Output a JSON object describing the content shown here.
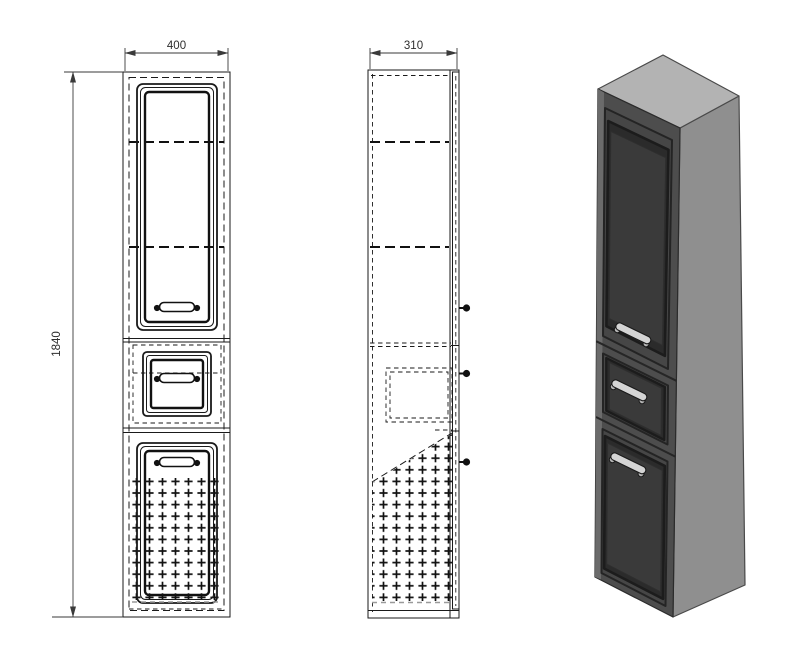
{
  "drawing": {
    "type": "furniture-technical-drawing",
    "views": {
      "front": "front-orthographic-view",
      "side": "side-orthographic-view",
      "perspective": "3d-perspective-view"
    },
    "dimensions": {
      "width": "400",
      "depth": "310",
      "height": "1840"
    },
    "colors": {
      "background": "#ffffff",
      "line": "#1a1a1a",
      "dim_line": "#3a3a3a",
      "gray_dash": "#9a9a9a",
      "top_face": "#b3b3b3",
      "side_face": "#8f8f8f",
      "front_face": "#4d4d4d",
      "door_frame": "#464646",
      "door_recess": "#2b2b2b",
      "door_panel": "#3a3a3a",
      "handle_metal": "#d4d4d4",
      "handle_dark": "#111111"
    }
  }
}
